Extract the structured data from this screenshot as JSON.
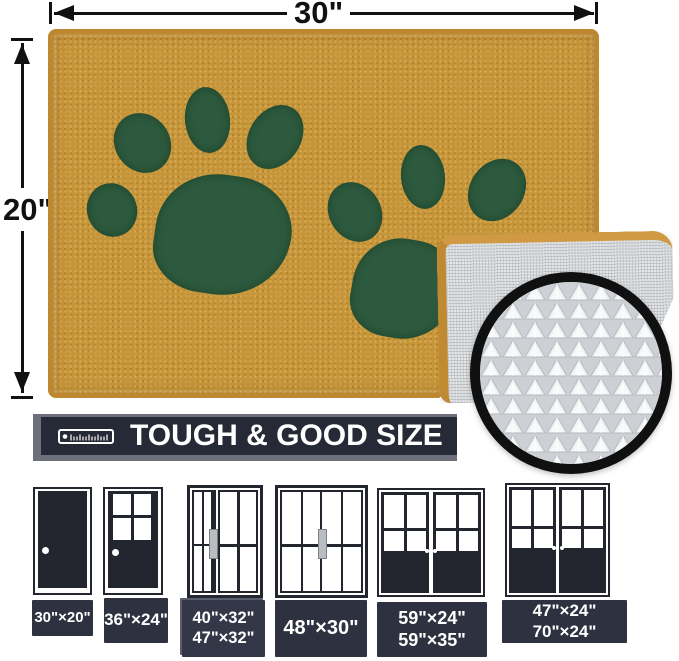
{
  "dimensions": {
    "width": "30\"",
    "height": "20\""
  },
  "banner": {
    "title": "TOUGH & GOOD SIZE"
  },
  "mat": {
    "front_color": "#c6953a",
    "border_color": "#bd8830",
    "paw_color": "#2d5a3e",
    "backing_color": "#e4e6e8",
    "magnifier_ring_color": "#101010"
  },
  "doors": [
    {
      "id": "single-solid-door",
      "sizes": [
        "30\"×20\""
      ]
    },
    {
      "id": "single-half-glass-door",
      "sizes": [
        "36\"×24\""
      ]
    },
    {
      "id": "sliding-door-asymmetric",
      "sizes": [
        "40\"×32\"",
        "47\"×32\""
      ]
    },
    {
      "id": "sliding-door",
      "sizes": [
        "48\"×30\""
      ]
    },
    {
      "id": "french-double-door",
      "sizes": [
        "59\"×24\"",
        "59\"×35\""
      ]
    },
    {
      "id": "french-double-door-wide",
      "sizes": [
        "47\"×24\"",
        "70\"×24\""
      ]
    }
  ],
  "icons": {
    "ruler": "ruler-icon"
  }
}
